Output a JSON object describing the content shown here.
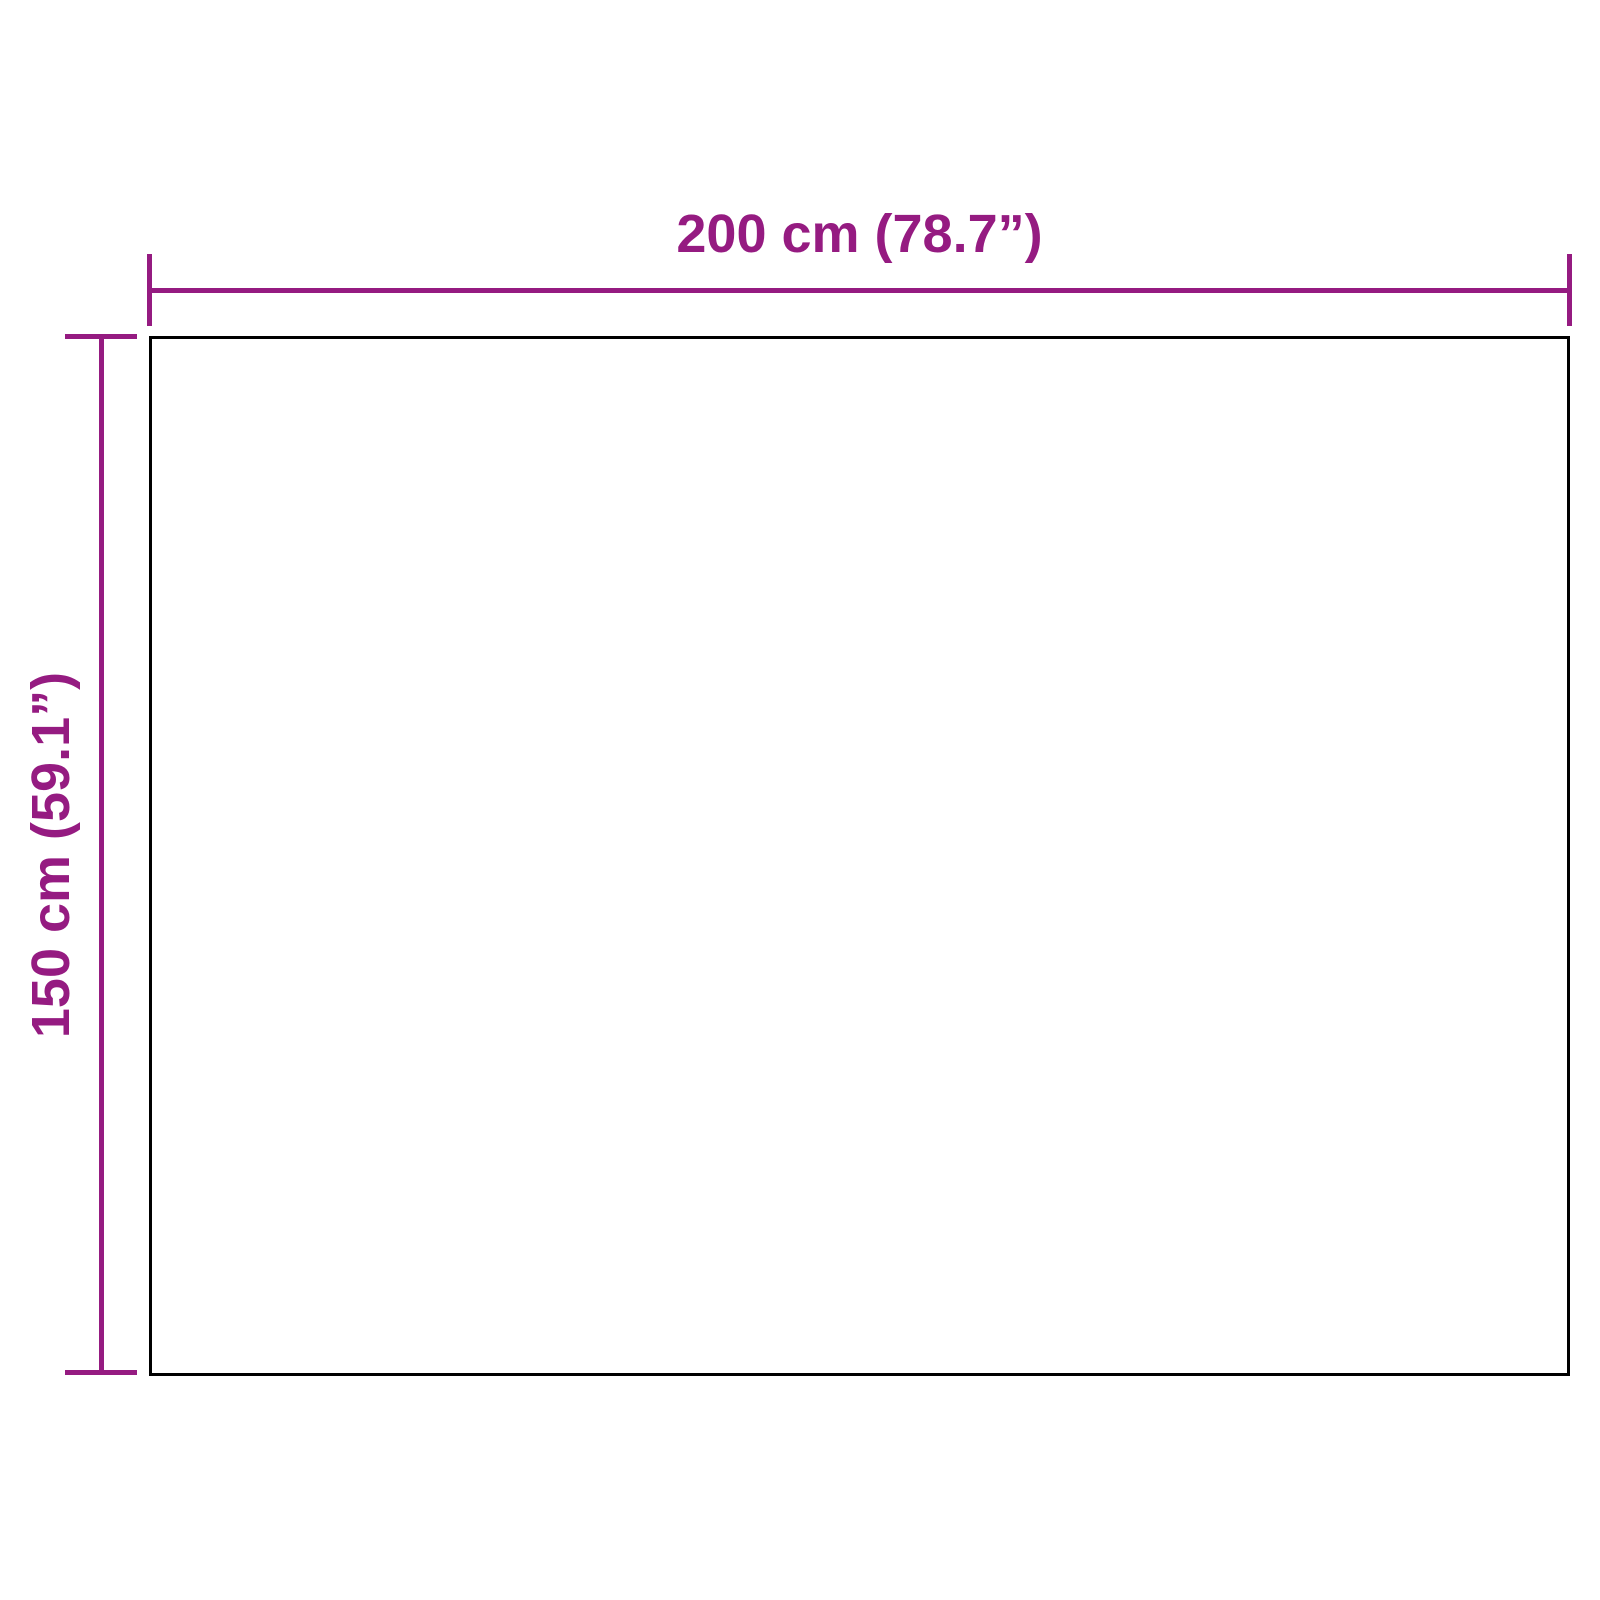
{
  "diagram": {
    "kind": "product-dimension-diagram",
    "background_color": "#ffffff",
    "accent_color": "#951B81",
    "outline_color": "#000000",
    "width_dimension": {
      "label": "200 cm (78.7”)"
    },
    "height_dimension": {
      "label": "150 cm (59.1”)"
    }
  }
}
